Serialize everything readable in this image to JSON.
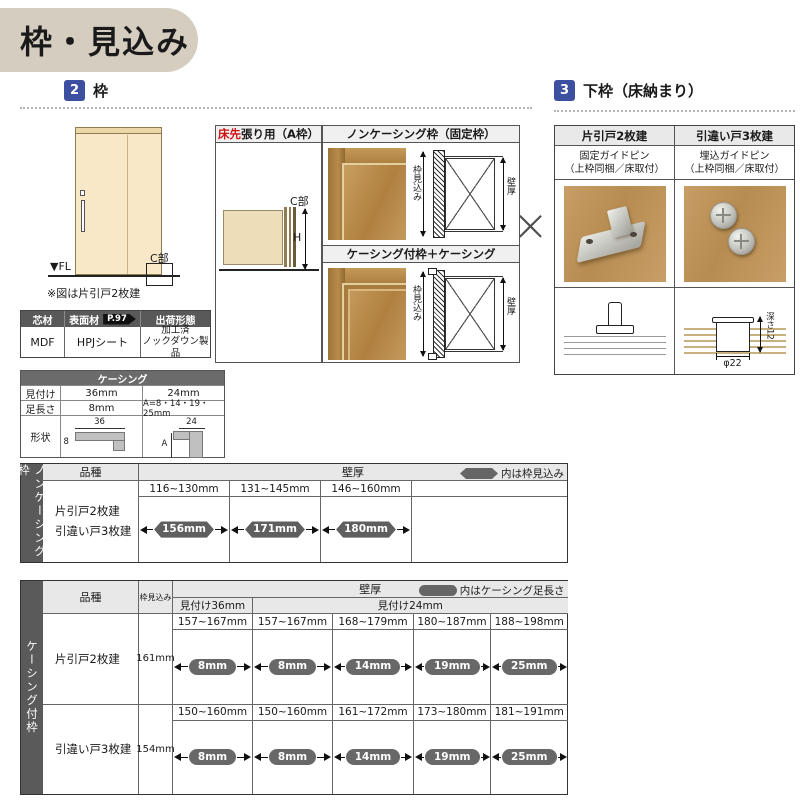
{
  "colors": {
    "accent_blue": "#3d4fa0",
    "title_banner_bg": "#d5cec0",
    "dark_header_gray": "#595959",
    "light_header_gray": "#e8e8e8",
    "badge_gray": "#5f5f5f",
    "red_accent": "#cc1111",
    "wood": "#c49a62",
    "door_fill": "#f8e8c8"
  },
  "title": "枠・見込み",
  "cross_mark": "×",
  "section2": {
    "num": "2",
    "title": "枠",
    "door": {
      "fl_label": "▼FL",
      "c_label": "C部",
      "note": "※図は片引戸2枚建"
    },
    "aframe_box": {
      "title_red": "床先",
      "title_rest": "張り用（A枠）",
      "c_label": "C部",
      "h_label": "H"
    },
    "noncasing_box": {
      "title": "ノンケーシング枠（固定枠）",
      "depth_label": "枠見込み",
      "wall_label": "壁厚"
    },
    "casing_box": {
      "title": "ケーシング付枠＋ケーシング",
      "depth_label": "枠見込み",
      "wall_label": "壁厚"
    },
    "material_table": {
      "h_core": "芯材",
      "h_surface": "表面材",
      "page_ref": "P.97",
      "h_shipping": "出荷形態",
      "core": "MDF",
      "surface": "HPJシート",
      "shipping": "加工済\nノックダウン製品"
    },
    "casing_spec": {
      "title": "ケーシング",
      "r1_label": "見付け",
      "r1_c36": "36mm",
      "r1_c24": "24mm",
      "r2_label": "足長さ",
      "r2_c36": "8mm",
      "r2_c24": "A=8・14・19・25mm",
      "r3_label": "形状",
      "dim36_w": "36",
      "dim36_t": "8",
      "dim24_w": "24",
      "dim24_a": "A"
    }
  },
  "section3": {
    "num": "3",
    "title": "下枠（床納まり）",
    "cols": [
      {
        "header": "片引戸2枚建",
        "sub": "固定ガイドピン\n（上枠同梱／床取付）"
      },
      {
        "header": "引違い戸3枚建",
        "sub": "埋込ガイドピン\n（上枠同梱／床取付）"
      }
    ],
    "dia": {
      "diameter": "φ22",
      "depth": "深さ12"
    }
  },
  "noncasing_table": {
    "side_label": "ノンケーシング枠",
    "kind_header": "品種",
    "wall_header": "壁厚",
    "note": "内は枠見込み",
    "kinds": "片引戸2枚建\n引違い戸3枚建",
    "cols": [
      {
        "range": "116~130mm",
        "value": "156mm"
      },
      {
        "range": "131~145mm",
        "value": "171mm"
      },
      {
        "range": "146~160mm",
        "value": "180mm"
      }
    ]
  },
  "casing_table": {
    "side_label": "ケーシング付枠",
    "kind_header": "品種",
    "depth_header": "枠見込み",
    "wall_header": "壁厚",
    "note": "内はケーシング足長さ",
    "mitsuke36": "見付け36mm",
    "mitsuke24": "見付け24mm",
    "rows": [
      {
        "kind": "片引戸2枚建",
        "depth": "161mm",
        "cols": [
          {
            "range": "157~167mm",
            "value": "8mm"
          },
          {
            "range": "157~167mm",
            "value": "8mm"
          },
          {
            "range": "168~179mm",
            "value": "14mm"
          },
          {
            "range": "180~187mm",
            "value": "19mm"
          },
          {
            "range": "188~198mm",
            "value": "25mm"
          }
        ]
      },
      {
        "kind": "引違い戸3枚建",
        "depth": "154mm",
        "cols": [
          {
            "range": "150~160mm",
            "value": "8mm"
          },
          {
            "range": "150~160mm",
            "value": "8mm"
          },
          {
            "range": "161~172mm",
            "value": "14mm"
          },
          {
            "range": "173~180mm",
            "value": "19mm"
          },
          {
            "range": "181~191mm",
            "value": "25mm"
          }
        ]
      }
    ]
  }
}
